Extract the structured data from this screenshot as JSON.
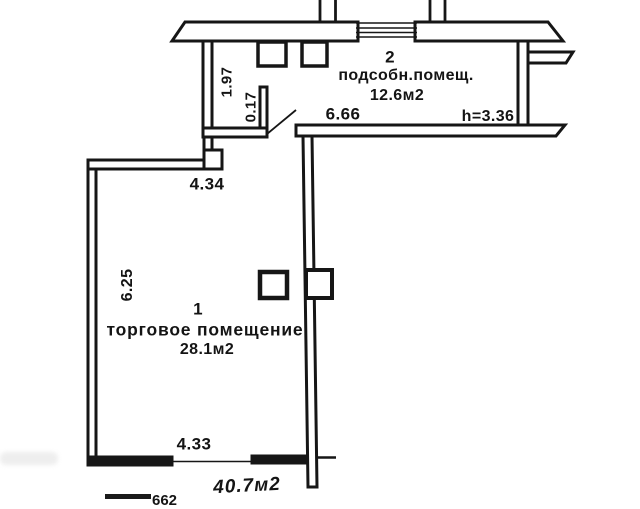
{
  "colors": {
    "ink": "#161616",
    "paper": "#ffffff"
  },
  "rooms": {
    "utility": {
      "number": "2",
      "name": "подсобн.помещ.",
      "area": "12.6м2"
    },
    "retail": {
      "number": "1",
      "name": "торговое помещение",
      "area": "28.1м2"
    }
  },
  "dimensions": {
    "room2_width": "6.66",
    "room2_left_wall": "1.97",
    "wall_offset": "0.17",
    "height_note": "h=3.36",
    "room1_top_width": "4.34",
    "room1_left_height": "6.25",
    "room1_bottom_width": "4.33"
  },
  "total_area_note": "40.7м2",
  "clipped_bottom_text": "662"
}
